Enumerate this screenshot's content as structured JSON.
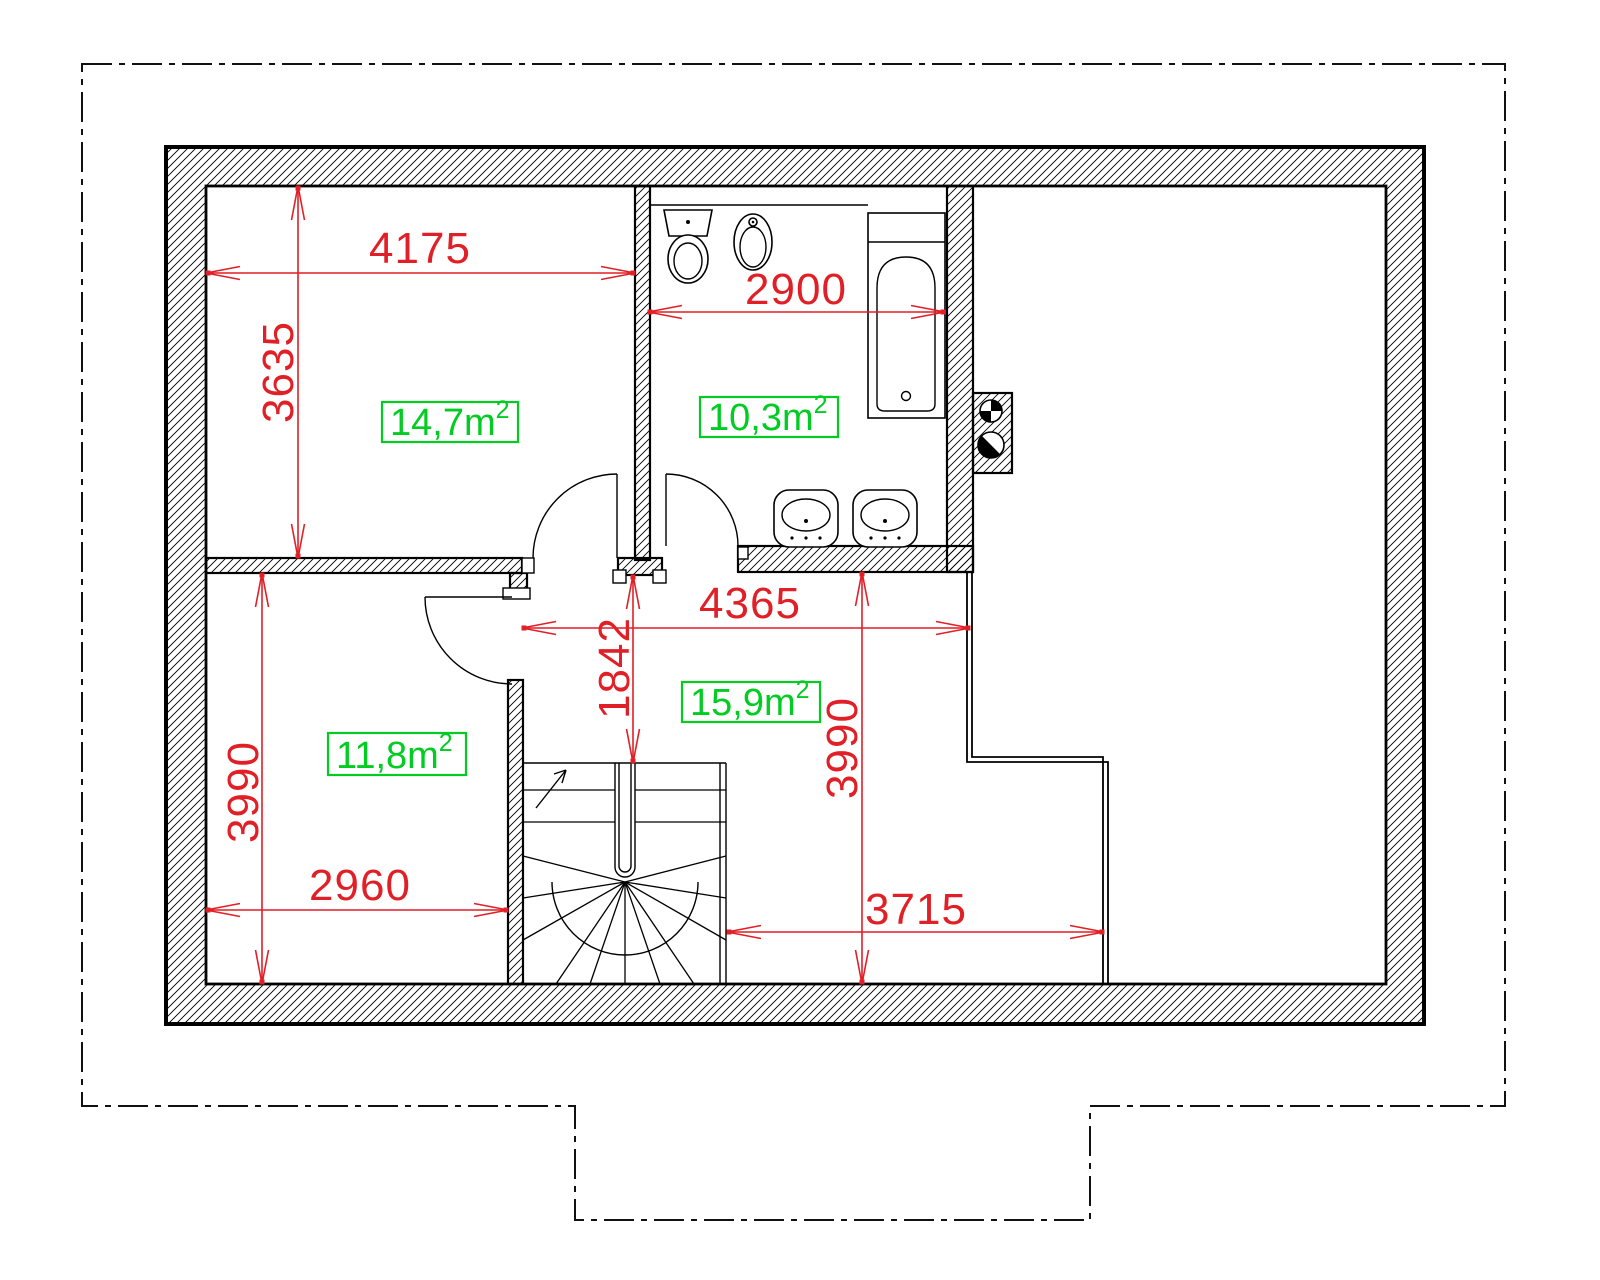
{
  "meta": {
    "drawing_type": "architectural floor plan",
    "units": "mm",
    "background": "#ffffff"
  },
  "colors": {
    "dimension_red": "#e11f26",
    "area_green": "#00cc22",
    "line_black": "#000000"
  },
  "dimensions": {
    "room_top_left_width": "4175",
    "room_top_left_depth": "3635",
    "bathroom_width": "2900",
    "hall_width": "4365",
    "hall_entry_depth": "1842",
    "room_bottom_left_depth": "3990",
    "hall_depth": "3990",
    "room_bottom_left_width": "2960",
    "hall_lower_width": "3715"
  },
  "areas": {
    "room_top_left": {
      "full": "14,7m²",
      "main": "14,7m",
      "sup": "2"
    },
    "bathroom": {
      "full": "10,3m²",
      "main": "10,3m",
      "sup": "2"
    },
    "hall": {
      "full": "15,9m²",
      "main": "15,9m",
      "sup": "2"
    },
    "room_bottom_left": {
      "full": "11,8m²",
      "main": "11,8m",
      "sup": "2"
    }
  },
  "fixtures": [
    "toilet-icon",
    "bidet-icon",
    "bathtub-icon",
    "washbasin-icon",
    "washbasin-icon",
    "vent-flue-icon",
    "chimney-flue-icon",
    "winder-staircase",
    "stair-direction-arrow",
    "door-swing"
  ]
}
